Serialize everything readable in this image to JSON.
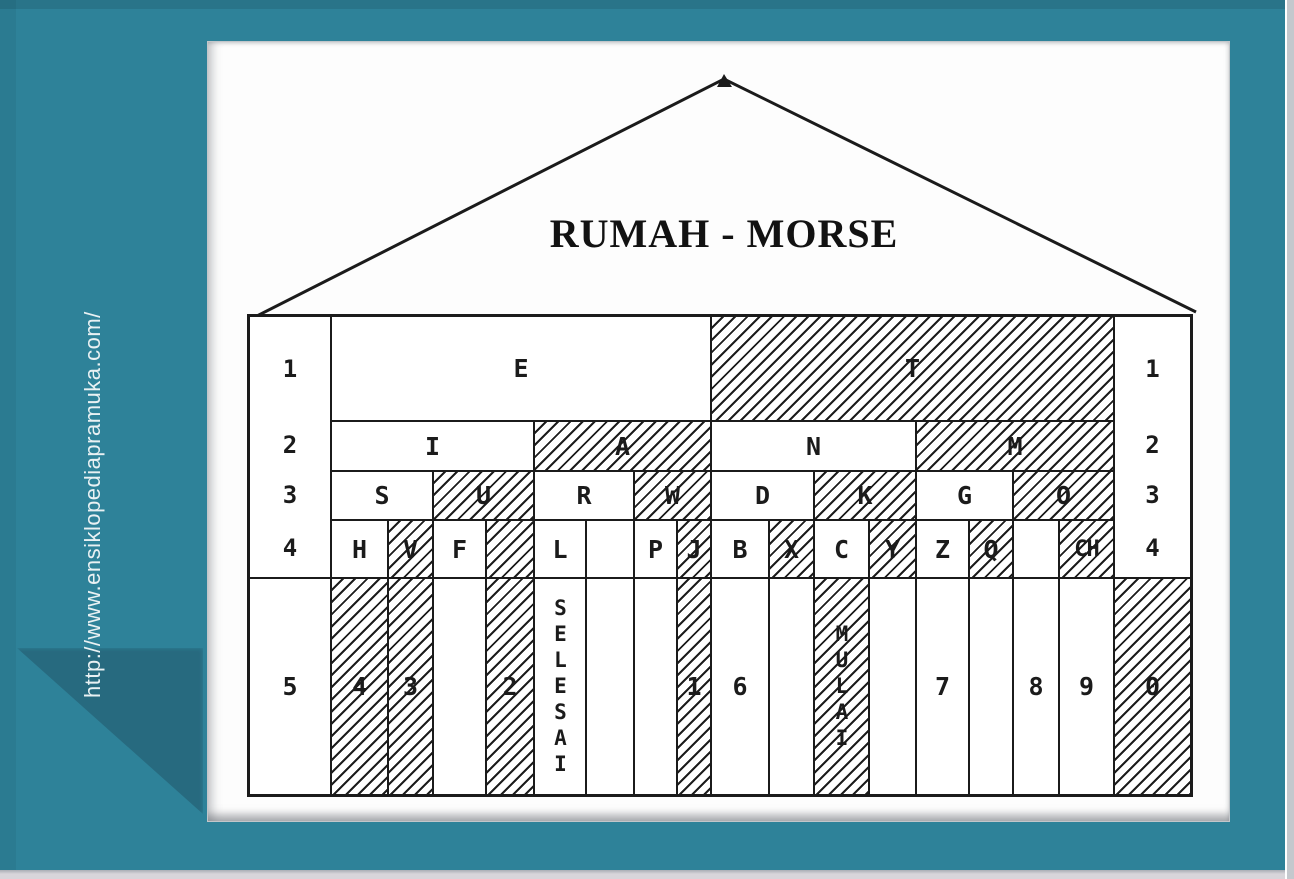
{
  "colors": {
    "background": "#2E8299",
    "corner_shadow": "#27697E",
    "ink": "#1B1B1B",
    "card": "#FDFDFD"
  },
  "watermark": {
    "url": "http://www.ensiklopediapramuka.com/"
  },
  "diagram": {
    "title": "RUMAH - MORSE",
    "side_labels_left": [
      "1",
      "2",
      "3",
      "4"
    ],
    "side_labels_right": [
      "1",
      "2",
      "3",
      "4"
    ],
    "bottom_left_label": {
      "text": "5",
      "hatched": false
    },
    "bottom_right_label": {
      "text": "0",
      "hatched": true
    },
    "cells": [
      {
        "name": "E",
        "row": 1,
        "col": 2,
        "span": 8,
        "hatched": false
      },
      {
        "name": "T",
        "row": 1,
        "col": 10,
        "span": 8,
        "hatched": true
      },
      {
        "name": "I",
        "row": 2,
        "col": 2,
        "span": 4,
        "hatched": false
      },
      {
        "name": "A",
        "row": 2,
        "col": 6,
        "span": 4,
        "hatched": true
      },
      {
        "name": "N",
        "row": 2,
        "col": 10,
        "span": 4,
        "hatched": false
      },
      {
        "name": "M",
        "row": 2,
        "col": 14,
        "span": 4,
        "hatched": true
      },
      {
        "name": "S",
        "row": 3,
        "col": 2,
        "span": 2,
        "hatched": false
      },
      {
        "name": "U",
        "row": 3,
        "col": 4,
        "span": 2,
        "hatched": true
      },
      {
        "name": "R",
        "row": 3,
        "col": 6,
        "span": 2,
        "hatched": false
      },
      {
        "name": "W",
        "row": 3,
        "col": 8,
        "span": 2,
        "hatched": true
      },
      {
        "name": "D",
        "row": 3,
        "col": 10,
        "span": 2,
        "hatched": false
      },
      {
        "name": "K",
        "row": 3,
        "col": 12,
        "span": 2,
        "hatched": true
      },
      {
        "name": "G",
        "row": 3,
        "col": 14,
        "span": 2,
        "hatched": false
      },
      {
        "name": "O",
        "row": 3,
        "col": 16,
        "span": 2,
        "hatched": true
      },
      {
        "name": "H",
        "row": 4,
        "col": 2,
        "span": 1,
        "hatched": false
      },
      {
        "name": "V",
        "row": 4,
        "col": 3,
        "span": 1,
        "hatched": true
      },
      {
        "name": "F",
        "row": 4,
        "col": 4,
        "span": 1,
        "hatched": false
      },
      {
        "name": "",
        "row": 4,
        "col": 5,
        "span": 1,
        "hatched": true
      },
      {
        "name": "L",
        "row": 4,
        "col": 6,
        "span": 1,
        "hatched": false
      },
      {
        "name": "",
        "row": 4,
        "col": 7,
        "span": 1,
        "hatched": false
      },
      {
        "name": "P",
        "row": 4,
        "col": 8,
        "span": 1,
        "hatched": false
      },
      {
        "name": "J",
        "row": 4,
        "col": 9,
        "span": 1,
        "hatched": true
      },
      {
        "name": "B",
        "row": 4,
        "col": 10,
        "span": 1,
        "hatched": false
      },
      {
        "name": "X",
        "row": 4,
        "col": 11,
        "span": 1,
        "hatched": true
      },
      {
        "name": "C",
        "row": 4,
        "col": 12,
        "span": 1,
        "hatched": false
      },
      {
        "name": "Y",
        "row": 4,
        "col": 13,
        "span": 1,
        "hatched": true
      },
      {
        "name": "Z",
        "row": 4,
        "col": 14,
        "span": 1,
        "hatched": false
      },
      {
        "name": "Q",
        "row": 4,
        "col": 15,
        "span": 1,
        "hatched": true
      },
      {
        "name": "",
        "row": 4,
        "col": 16,
        "span": 1,
        "hatched": false
      },
      {
        "name": "CH",
        "row": 4,
        "col": 17,
        "span": 1,
        "hatched": true,
        "small": true
      },
      {
        "name": "4",
        "row": 5,
        "col": 2,
        "span": 1,
        "hatched": true
      },
      {
        "name": "3",
        "row": 5,
        "col": 3,
        "span": 1,
        "hatched": true
      },
      {
        "name": "",
        "row": 5,
        "col": 4,
        "span": 1,
        "hatched": false
      },
      {
        "name": "2",
        "row": 5,
        "col": 5,
        "span": 1,
        "hatched": true
      },
      {
        "name": "SELESAI",
        "row": 5,
        "col": 6,
        "span": 1,
        "hatched": false,
        "vertical": true
      },
      {
        "name": "",
        "row": 5,
        "col": 7,
        "span": 1,
        "hatched": false
      },
      {
        "name": "",
        "row": 5,
        "col": 8,
        "span": 1,
        "hatched": false
      },
      {
        "name": "1",
        "row": 5,
        "col": 9,
        "span": 1,
        "hatched": true
      },
      {
        "name": "6",
        "row": 5,
        "col": 10,
        "span": 1,
        "hatched": false
      },
      {
        "name": "",
        "row": 5,
        "col": 11,
        "span": 1,
        "hatched": false
      },
      {
        "name": "MULAI",
        "row": 5,
        "col": 12,
        "span": 1,
        "hatched": true,
        "vertical": true
      },
      {
        "name": "",
        "row": 5,
        "col": 13,
        "span": 1,
        "hatched": false
      },
      {
        "name": "7",
        "row": 5,
        "col": 14,
        "span": 1,
        "hatched": false
      },
      {
        "name": "",
        "row": 5,
        "col": 15,
        "span": 1,
        "hatched": false
      },
      {
        "name": "8",
        "row": 5,
        "col": 16,
        "span": 1,
        "hatched": false
      },
      {
        "name": "9",
        "row": 5,
        "col": 17,
        "span": 1,
        "hatched": false
      }
    ]
  }
}
